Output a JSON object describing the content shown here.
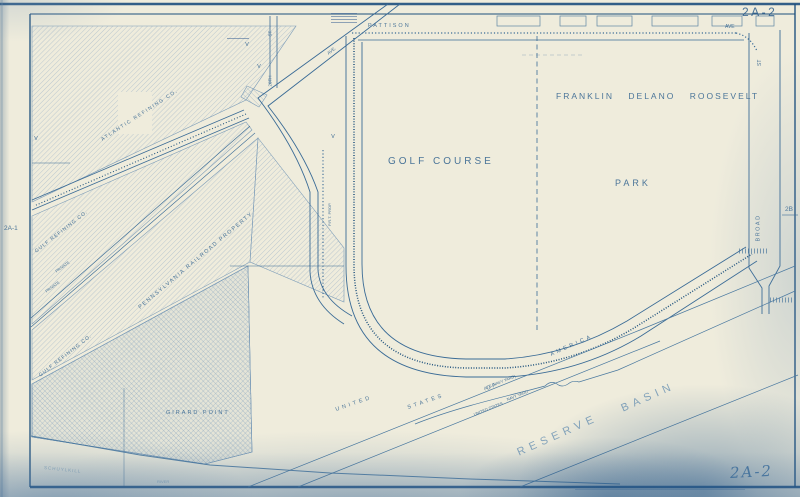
{
  "sheet": {
    "number": "2A-2",
    "number_handwritten": "2A-2",
    "adjacent_left": "2A-1",
    "adjacent_right": "2B",
    "colors": {
      "paper": "#efecdc",
      "ink": "#2f618e",
      "ink_light": "#6b93b4",
      "stain": "#23557f"
    }
  },
  "streets": {
    "pattison": "PATTISON",
    "pattison_suffix": "AVE",
    "broad": "BROAD",
    "broad_suffix": "ST",
    "twentieth": "20TH",
    "twentieth_suffix": "ST",
    "penrose_suffix": "AVE."
  },
  "areas": {
    "golf_course": "GOLF COURSE",
    "fdr_park_line1": "FRANKLIN DELANO ROOSEVELT",
    "fdr_park_line2": "PARK",
    "girard_point": "GIRARD POINT",
    "reserve": "RESERVE",
    "basin": "BASIN",
    "usa_1": "UNITED",
    "usa_2": "STATES",
    "usa_3": "OF",
    "usa_4": "AMERICA"
  },
  "owners": {
    "atlantic": "ATLANTIC REFINING CO.",
    "gulf": "GULF REFINING CO.",
    "prr": "PENNSYLVANIA RAILROAD PROPERTY",
    "prt": "P.R.T. PROP.",
    "private": "PRIVATE",
    "navy_paren": "(U.S. NAVY YARD)",
    "navy_yard": "NAVY YARD",
    "united_states_small": "UNITED STATES"
  },
  "water": {
    "schuylkill": "SCHUYLKILL",
    "river": "RIVER"
  },
  "marks": {
    "v": "V"
  }
}
